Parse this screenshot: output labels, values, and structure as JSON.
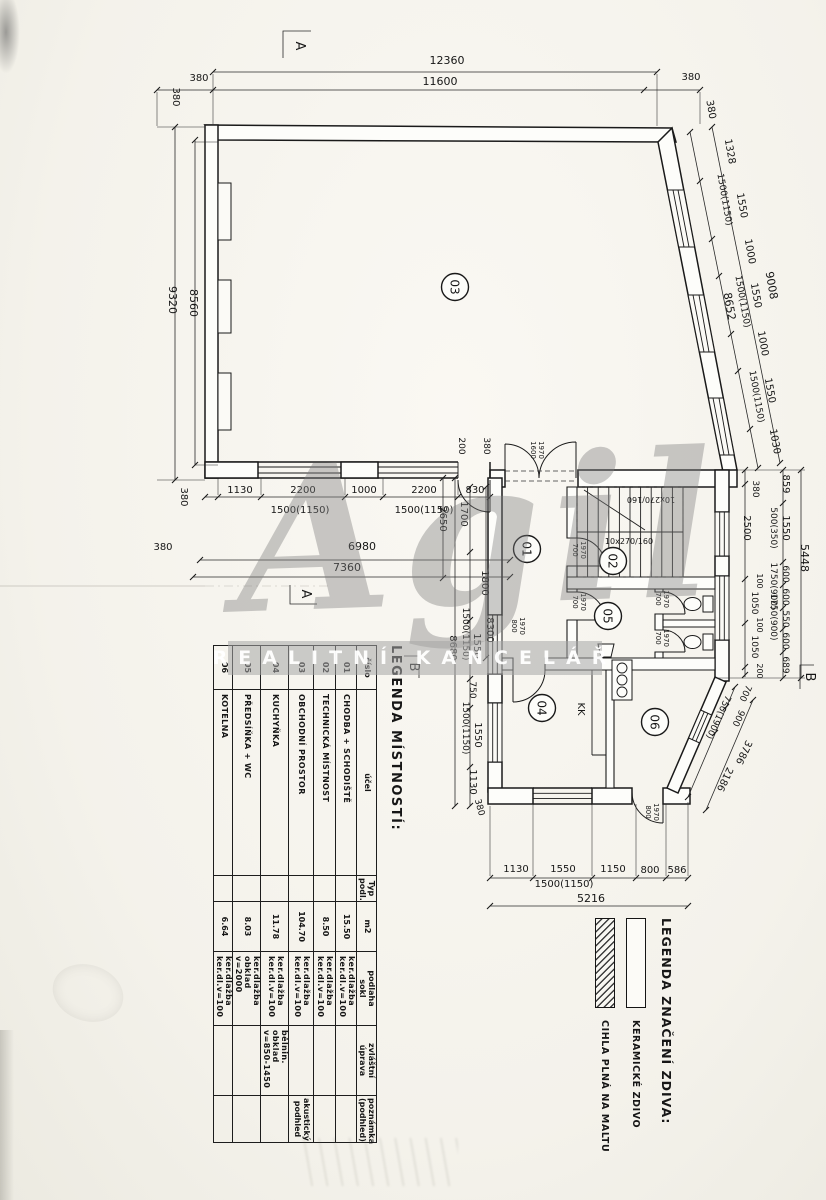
{
  "watermark": {
    "script": "Agil",
    "banner": "REALITNÍ KANCELÁŘ"
  },
  "legend_rooms": {
    "title": "LEGENDA MÍSTNOSTÍ:",
    "columns": [
      "číslo",
      "účel",
      "Typ\npodl.",
      "m2",
      "podlaha\nsokl",
      "zvláštní\núprava",
      "poznámka\n(podhled)"
    ],
    "rows": [
      [
        "01",
        "CHODBA + SCHODIŠTĚ",
        "",
        "15.50",
        "ker.dlažba\nker.dl.v=100",
        "",
        ""
      ],
      [
        "02",
        "TECHNICKÁ MÍSTNOST",
        "",
        "8.50",
        "ker.dlažba\nker.dl.v=100",
        "",
        ""
      ],
      [
        "03",
        "OBCHODNÍ PROSTOR",
        "",
        "104.70",
        "ker.dlažba\nker.dl.v=100",
        "",
        "akustický podhled"
      ],
      [
        "04",
        "KUCHYŇKA",
        "",
        "11.78",
        "ker.dlažba\nker.dl.v=100",
        "bělnin. obklad\nv=850-1450",
        ""
      ],
      [
        "05",
        "PŘEDSÍŇKA + WC",
        "",
        "8.03",
        "ker.dlažba\nobklad v=2000",
        "",
        ""
      ],
      [
        "06",
        "KOTELNA",
        "",
        "6.64",
        "ker.dlažba\nker.dl.v=100",
        "",
        ""
      ]
    ]
  },
  "legend_walls": {
    "title": "LEGENDA ZNAČENÍ ZDIVA:",
    "items": [
      {
        "label": "KERAMICKÉ ZDIVO",
        "pattern": "plain"
      },
      {
        "label": "CIHLA PLNÁ NA MALTU",
        "pattern": "hatch"
      }
    ]
  },
  "plan": {
    "rooms": [
      {
        "n": "01",
        "x": 527,
        "y": 549
      },
      {
        "n": "02",
        "x": 613,
        "y": 561
      },
      {
        "n": "03",
        "x": 455,
        "y": 287
      },
      {
        "n": "04",
        "x": 542,
        "y": 708
      },
      {
        "n": "05",
        "x": 608,
        "y": 616
      },
      {
        "n": "06",
        "x": 655,
        "y": 722
      }
    ],
    "labels": [
      {
        "t": "12360",
        "x": 447,
        "y": 64,
        "r": 0,
        "s": 11
      },
      {
        "t": "11600",
        "x": 440,
        "y": 85,
        "r": 0,
        "s": 11
      },
      {
        "t": "380",
        "x": 199,
        "y": 81,
        "r": 0,
        "s": 10
      },
      {
        "t": "380",
        "x": 691,
        "y": 80,
        "r": 0,
        "s": 10
      },
      {
        "t": "380",
        "x": 173,
        "y": 97,
        "r": 90,
        "s": 10
      },
      {
        "t": "380",
        "x": 708,
        "y": 110,
        "r": 80,
        "s": 10
      },
      {
        "t": "9320",
        "x": 169,
        "y": 300,
        "r": 90,
        "s": 11
      },
      {
        "t": "8560",
        "x": 190,
        "y": 303,
        "r": 90,
        "s": 11
      },
      {
        "t": "380",
        "x": 181,
        "y": 497,
        "r": 90,
        "s": 10
      },
      {
        "t": "380",
        "x": 163,
        "y": 550,
        "r": 0,
        "s": 10
      },
      {
        "t": "1130",
        "x": 240,
        "y": 493,
        "r": 0,
        "s": 10
      },
      {
        "t": "2200",
        "x": 303,
        "y": 493,
        "r": 0,
        "s": 10
      },
      {
        "t": "1000",
        "x": 364,
        "y": 493,
        "r": 0,
        "s": 10
      },
      {
        "t": "2200",
        "x": 424,
        "y": 493,
        "r": 0,
        "s": 10
      },
      {
        "t": "1500(1150)",
        "x": 300,
        "y": 513,
        "r": 0,
        "s": 10
      },
      {
        "t": "1500(1150)",
        "x": 424,
        "y": 513,
        "r": 0,
        "s": 10
      },
      {
        "t": "830",
        "x": 475,
        "y": 493,
        "r": 0,
        "s": 10
      },
      {
        "t": "6980",
        "x": 362,
        "y": 550,
        "r": 0,
        "s": 11
      },
      {
        "t": "7360",
        "x": 347,
        "y": 571,
        "r": 0,
        "s": 11
      },
      {
        "t": "200",
        "x": 459,
        "y": 446,
        "r": 90,
        "s": 9
      },
      {
        "t": "380",
        "x": 484,
        "y": 446,
        "r": 90,
        "s": 9
      },
      {
        "t": "2650",
        "x": 440,
        "y": 519,
        "r": 90,
        "s": 10
      },
      {
        "t": "1700",
        "x": 461,
        "y": 514,
        "r": 90,
        "s": 10
      },
      {
        "t": "1800",
        "x": 482,
        "y": 583,
        "r": 90,
        "s": 10
      },
      {
        "t": "8300",
        "x": 487,
        "y": 630,
        "r": 90,
        "s": 10
      },
      {
        "t": "1500(1150)",
        "x": 463,
        "y": 634,
        "r": 90,
        "s": 9
      },
      {
        "t": "1550",
        "x": 474,
        "y": 646,
        "r": 90,
        "s": 10
      },
      {
        "t": "8680",
        "x": 450,
        "y": 648,
        "r": 90,
        "s": 10
      },
      {
        "t": "750",
        "x": 470,
        "y": 690,
        "r": 90,
        "s": 9
      },
      {
        "t": "1500(1150)",
        "x": 463,
        "y": 728,
        "r": 90,
        "s": 9
      },
      {
        "t": "1550",
        "x": 475,
        "y": 735,
        "r": 90,
        "s": 10
      },
      {
        "t": "1130",
        "x": 470,
        "y": 782,
        "r": 90,
        "s": 10
      },
      {
        "t": "380",
        "x": 477,
        "y": 808,
        "r": 75,
        "s": 9
      },
      {
        "t": "1130",
        "x": 516,
        "y": 872,
        "r": 0,
        "s": 10
      },
      {
        "t": "1550",
        "x": 563,
        "y": 872,
        "r": 0,
        "s": 10
      },
      {
        "t": "1150",
        "x": 613,
        "y": 872,
        "r": 0,
        "s": 10
      },
      {
        "t": "800",
        "x": 650,
        "y": 873,
        "r": 0,
        "s": 10
      },
      {
        "t": "586",
        "x": 677,
        "y": 873,
        "r": 0,
        "s": 10
      },
      {
        "t": "1500(1150)",
        "x": 564,
        "y": 887,
        "r": 0,
        "s": 10
      },
      {
        "t": "5216",
        "x": 591,
        "y": 902,
        "r": 0,
        "s": 11
      },
      {
        "t": "1328",
        "x": 727,
        "y": 152,
        "r": 80,
        "s": 10
      },
      {
        "t": "1500(1150)",
        "x": 722,
        "y": 200,
        "r": 80,
        "s": 9
      },
      {
        "t": "1550",
        "x": 739,
        "y": 206,
        "r": 80,
        "s": 10
      },
      {
        "t": "1000",
        "x": 747,
        "y": 252,
        "r": 80,
        "s": 10
      },
      {
        "t": "9008",
        "x": 768,
        "y": 286,
        "r": 80,
        "s": 11
      },
      {
        "t": "8652",
        "x": 726,
        "y": 307,
        "r": 80,
        "s": 11
      },
      {
        "t": "1550",
        "x": 753,
        "y": 296,
        "r": 80,
        "s": 10
      },
      {
        "t": "1500(1150)",
        "x": 740,
        "y": 302,
        "r": 80,
        "s": 9
      },
      {
        "t": "1000",
        "x": 760,
        "y": 344,
        "r": 80,
        "s": 10
      },
      {
        "t": "1550",
        "x": 767,
        "y": 391,
        "r": 80,
        "s": 10
      },
      {
        "t": "1500(1150)",
        "x": 754,
        "y": 397,
        "r": 80,
        "s": 9
      },
      {
        "t": "1030",
        "x": 772,
        "y": 442,
        "r": 80,
        "s": 10
      },
      {
        "t": "380",
        "x": 753,
        "y": 489,
        "r": 90,
        "s": 9
      },
      {
        "t": "2500",
        "x": 744,
        "y": 528,
        "r": 90,
        "s": 10
      },
      {
        "t": "859",
        "x": 783,
        "y": 484,
        "r": 90,
        "s": 10
      },
      {
        "t": "1550",
        "x": 783,
        "y": 528,
        "r": 90,
        "s": 10
      },
      {
        "t": "500(350)",
        "x": 771,
        "y": 528,
        "r": 90,
        "s": 9
      },
      {
        "t": "5448",
        "x": 801,
        "y": 558,
        "r": 90,
        "s": 11
      },
      {
        "t": "600",
        "x": 783,
        "y": 574,
        "r": 90,
        "s": 9
      },
      {
        "t": "1750(900)",
        "x": 771,
        "y": 586,
        "r": 90,
        "s": 9
      },
      {
        "t": "600",
        "x": 783,
        "y": 597,
        "r": 90,
        "s": 9
      },
      {
        "t": "550",
        "x": 783,
        "y": 619,
        "r": 90,
        "s": 9
      },
      {
        "t": "1750(900)",
        "x": 771,
        "y": 617,
        "r": 90,
        "s": 9
      },
      {
        "t": "600",
        "x": 783,
        "y": 641,
        "r": 90,
        "s": 9
      },
      {
        "t": "689",
        "x": 783,
        "y": 665,
        "r": 90,
        "s": 9
      },
      {
        "t": "100",
        "x": 757,
        "y": 581,
        "r": 90,
        "s": 8
      },
      {
        "t": "1050",
        "x": 752,
        "y": 603,
        "r": 90,
        "s": 9
      },
      {
        "t": "100",
        "x": 757,
        "y": 625,
        "r": 90,
        "s": 8
      },
      {
        "t": "1050",
        "x": 752,
        "y": 647,
        "r": 90,
        "s": 9
      },
      {
        "t": "200",
        "x": 757,
        "y": 671,
        "r": 90,
        "s": 8
      },
      {
        "t": "700",
        "x": 743,
        "y": 692,
        "r": 115,
        "s": 9
      },
      {
        "t": "900",
        "x": 736,
        "y": 717,
        "r": 115,
        "s": 9
      },
      {
        "t": "750(1900)",
        "x": 716,
        "y": 716,
        "r": 115,
        "s": 9
      },
      {
        "t": "3786",
        "x": 741,
        "y": 751,
        "r": 115,
        "s": 10
      },
      {
        "t": "2186",
        "x": 722,
        "y": 778,
        "r": 115,
        "s": 10
      },
      {
        "t": "1600",
        "x": 531,
        "y": 450,
        "r": 90,
        "s": 7
      },
      {
        "t": "1970",
        "x": 539,
        "y": 450,
        "r": 90,
        "s": 7
      },
      {
        "t": "10x270/160",
        "x": 651,
        "y": 497,
        "r": 180,
        "s": 8
      },
      {
        "t": "10x270/160",
        "x": 629,
        "y": 544,
        "r": 0,
        "s": 8
      },
      {
        "t": "700",
        "x": 573,
        "y": 550,
        "r": 90,
        "s": 7
      },
      {
        "t": "1970",
        "x": 581,
        "y": 550,
        "r": 90,
        "s": 7
      },
      {
        "t": "700",
        "x": 573,
        "y": 602,
        "r": 90,
        "s": 7
      },
      {
        "t": "1970",
        "x": 581,
        "y": 602,
        "r": 90,
        "s": 7
      },
      {
        "t": "700",
        "x": 656,
        "y": 599,
        "r": 90,
        "s": 7
      },
      {
        "t": "1970",
        "x": 664,
        "y": 599,
        "r": 90,
        "s": 7
      },
      {
        "t": "700",
        "x": 656,
        "y": 638,
        "r": 90,
        "s": 7
      },
      {
        "t": "1970",
        "x": 664,
        "y": 638,
        "r": 90,
        "s": 7
      },
      {
        "t": "800",
        "x": 512,
        "y": 626,
        "r": 90,
        "s": 7
      },
      {
        "t": "1970",
        "x": 520,
        "y": 626,
        "r": 90,
        "s": 7
      },
      {
        "t": "800",
        "x": 646,
        "y": 812,
        "r": 90,
        "s": 7
      },
      {
        "t": "1970",
        "x": 654,
        "y": 812,
        "r": 90,
        "s": 7
      },
      {
        "t": "KK",
        "x": 578,
        "y": 709,
        "r": 90,
        "s": 10
      },
      {
        "t": "A",
        "x": 296,
        "y": 46,
        "r": 90,
        "s": 13
      },
      {
        "t": "A",
        "x": 302,
        "y": 594,
        "r": 90,
        "s": 13
      },
      {
        "t": "B",
        "x": 410,
        "y": 667,
        "r": 90,
        "s": 13
      },
      {
        "t": "B",
        "x": 806,
        "y": 677,
        "r": 90,
        "s": 13
      }
    ]
  }
}
